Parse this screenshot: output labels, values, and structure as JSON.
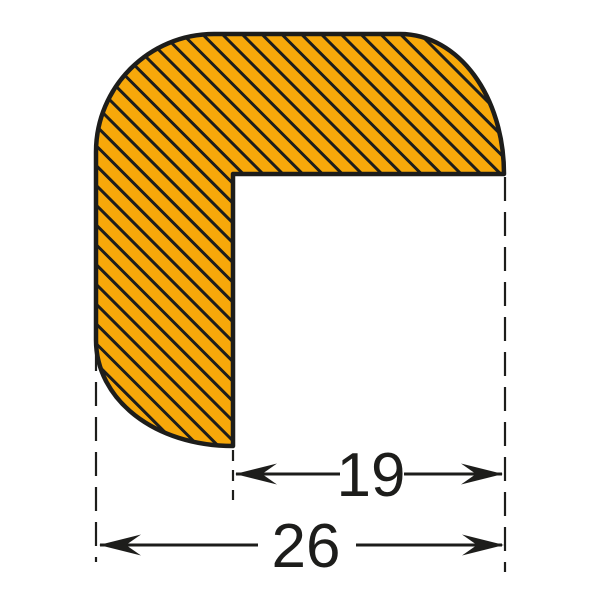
{
  "diagram": {
    "description": "cross-section of an L-shaped corner protection profile with diagonal hatching",
    "shape": "corner-angle-profile",
    "hatch_direction": "backslash-diagonal",
    "colors": {
      "profile_fill": "#F7A80A",
      "line_color": "#1D1D1B",
      "background": "#FFFFFF"
    },
    "dimensions": {
      "inner": {
        "value": "19"
      },
      "outer": {
        "value": "26"
      }
    }
  }
}
